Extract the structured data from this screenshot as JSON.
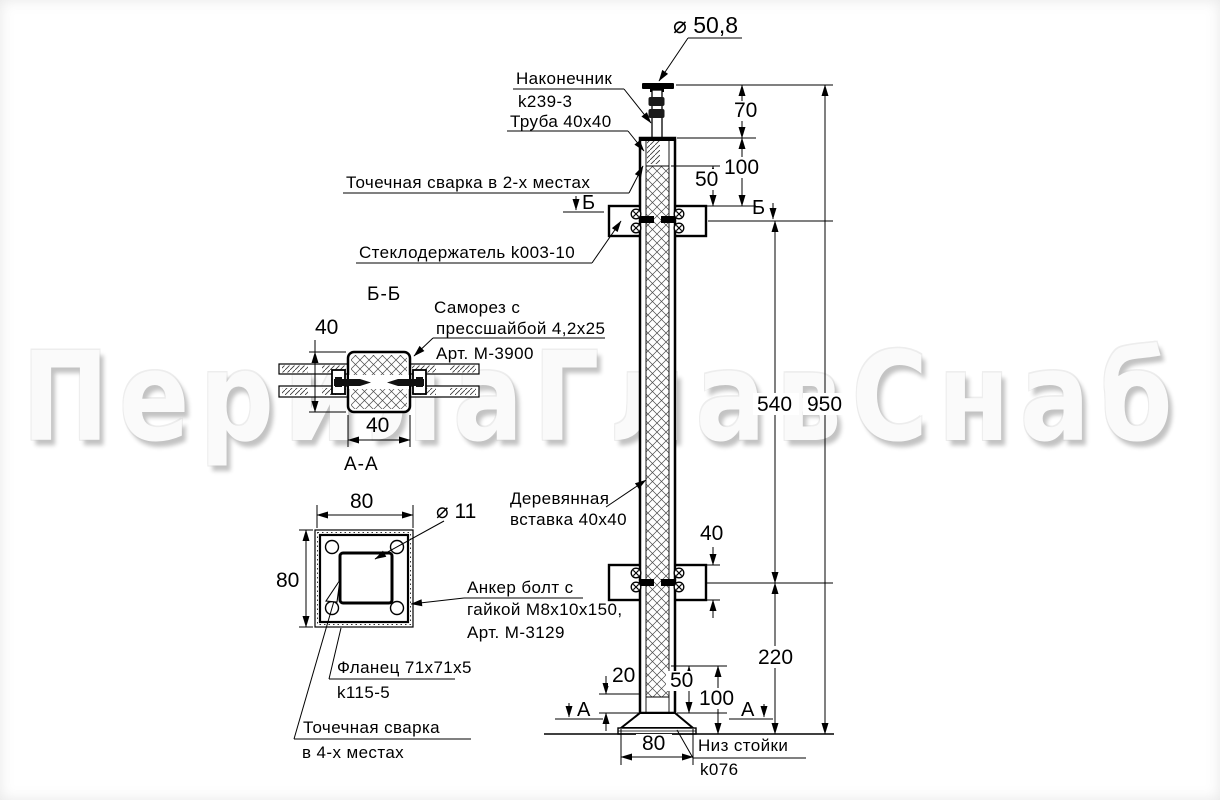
{
  "watermark": "ПерилаГлавСнаб",
  "callouts": {
    "tip_line1": "Наконечник",
    "tip_line2": "k239-3",
    "tube": "Труба 40x40",
    "spot_weld_2": "Точечная сварка в 2-х местах",
    "glass_holder": "Стеклодержатель k003-10",
    "screw_line1": "Саморез с",
    "screw_line2": "прессшайбой 4,2x25",
    "screw_line3": "Арт. М-3900",
    "wood_line1": "Деревянная",
    "wood_line2": "вставка 40x40",
    "anchor_line1": "Анкер болт с",
    "anchor_line2": "гайкой М8x10x150,",
    "anchor_line3": "Арт. М-3129",
    "flange_line1": "Фланец 71x71x5",
    "flange_line2": "k115-5",
    "spot_weld_4_line1": "Точечная сварка",
    "spot_weld_4_line2": "в 4-х местах",
    "bottom_line1": "Низ стойки",
    "bottom_line2": "k076"
  },
  "dimensions": {
    "top_diameter": "⌀ 50,8",
    "d70": "70",
    "d100_top": "100",
    "d50_top": "50",
    "d540": "540",
    "d950": "950",
    "d40_holder": "40",
    "d220": "220",
    "d20": "20",
    "d50_bottom": "50",
    "d100_bottom": "100",
    "d80_base": "80",
    "bb_40_v": "40",
    "bb_40_h": "40",
    "aa_80_top": "80",
    "aa_80_left": "80",
    "aa_hole": "⌀ 11"
  },
  "sections": {
    "bb_title": "Б-Б",
    "aa_title": "А-А",
    "b_marker": "Б",
    "a_marker": "А"
  }
}
